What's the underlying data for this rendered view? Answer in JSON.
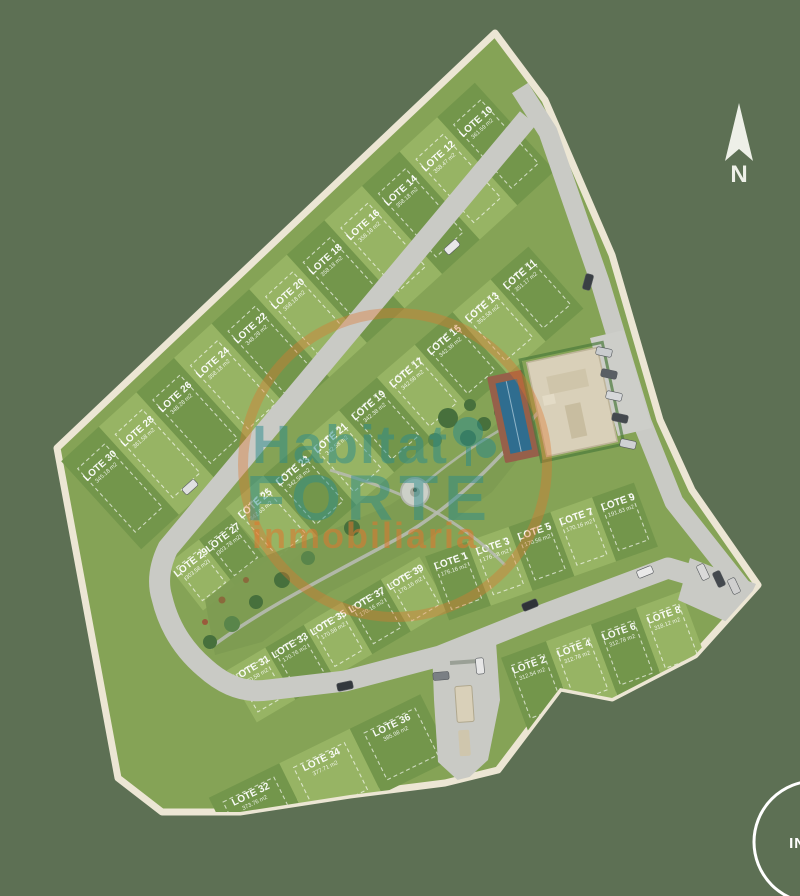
{
  "background_color": "#5d7054",
  "compass": {
    "label": "N"
  },
  "watermark": {
    "line1": "Habitat",
    "line2": "FORTE",
    "line3": "inmobiliaria",
    "teal": "#2a8c8c",
    "orange": "#e0772e"
  },
  "inicio_button": {
    "label": "INICIO"
  },
  "map": {
    "lot_label_prefix": "LOTE",
    "colors": {
      "lot_light": "#97b464",
      "lot_dark": "#73964b",
      "park": "#7d9c52",
      "road": "#c9cac5",
      "boundary": "#ece6d4",
      "site_base": "#85a356"
    },
    "lots": [
      {
        "id": 1,
        "label": "LOTE 1",
        "area": "176.16 m2"
      },
      {
        "id": 2,
        "label": "LOTE 2",
        "area": "312.54 m2"
      },
      {
        "id": 3,
        "label": "LOTE 3",
        "area": "176.58 m2"
      },
      {
        "id": 4,
        "label": "LOTE 4",
        "area": "312.78 m2"
      },
      {
        "id": 5,
        "label": "LOTE 5",
        "area": "170.56 m2"
      },
      {
        "id": 6,
        "label": "LOTE 6",
        "area": "312.78 m2"
      },
      {
        "id": 7,
        "label": "LOTE 7",
        "area": "170.16 m2"
      },
      {
        "id": 8,
        "label": "LOTE 8",
        "area": "318.12 m2"
      },
      {
        "id": 9,
        "label": "LOTE 9",
        "area": "191.63 m2"
      },
      {
        "id": 10,
        "label": "LOTE 10",
        "area": "361.59 m2"
      },
      {
        "id": 11,
        "label": "LOTE 11",
        "area": "351.17 m2"
      },
      {
        "id": 12,
        "label": "LOTE 12",
        "area": "358.47 m2"
      },
      {
        "id": 13,
        "label": "LOTE 13",
        "area": "352.58 m2"
      },
      {
        "id": 14,
        "label": "LOTE 14",
        "area": "358.18 m2"
      },
      {
        "id": 15,
        "label": "LOTE 15",
        "area": "342.38 m2"
      },
      {
        "id": 16,
        "label": "LOTE 16",
        "area": "358.18 m2"
      },
      {
        "id": 17,
        "label": "LOTE 17",
        "area": "342.58 m2"
      },
      {
        "id": 18,
        "label": "LOTE 18",
        "area": "358.18 m2"
      },
      {
        "id": 19,
        "label": "LOTE 19",
        "area": "342.38 m2"
      },
      {
        "id": 20,
        "label": "LOTE 20",
        "area": "358.18 m2"
      },
      {
        "id": 21,
        "label": "LOTE 21",
        "area": "342.58 m2"
      },
      {
        "id": 22,
        "label": "LOTE 22",
        "area": "348.28 m2"
      },
      {
        "id": 23,
        "label": "LOTE 23",
        "area": "342.58 m2"
      },
      {
        "id": 24,
        "label": "LOTE 24",
        "area": "358.18 m2"
      },
      {
        "id": 25,
        "label": "LOTE 25",
        "area": "342.63 m2"
      },
      {
        "id": 26,
        "label": "LOTE 26",
        "area": "348.28 m2"
      },
      {
        "id": 27,
        "label": "LOTE 27",
        "area": "303.78 m2"
      },
      {
        "id": 28,
        "label": "LOTE 28",
        "area": "361.58 m2"
      },
      {
        "id": 29,
        "label": "LOTE 29",
        "area": "303.58 m2"
      },
      {
        "id": 30,
        "label": "LOTE 30",
        "area": "345.18 m2"
      },
      {
        "id": 31,
        "label": "LOTE 31",
        "area": "170.58 m2"
      },
      {
        "id": 32,
        "label": "LOTE 32",
        "area": "373.76 m2"
      },
      {
        "id": 33,
        "label": "LOTE 33",
        "area": "170.76 m2"
      },
      {
        "id": 34,
        "label": "LOTE 34",
        "area": "377.71 m2"
      },
      {
        "id": 35,
        "label": "LOTE 35",
        "area": "170.58 m2"
      },
      {
        "id": 36,
        "label": "LOTE 36",
        "area": "385.98 m2"
      },
      {
        "id": 37,
        "label": "LOTE 37",
        "area": "170.16 m2"
      },
      {
        "id": 39,
        "label": "LOTE 39",
        "area": "176.16 m2"
      }
    ]
  }
}
